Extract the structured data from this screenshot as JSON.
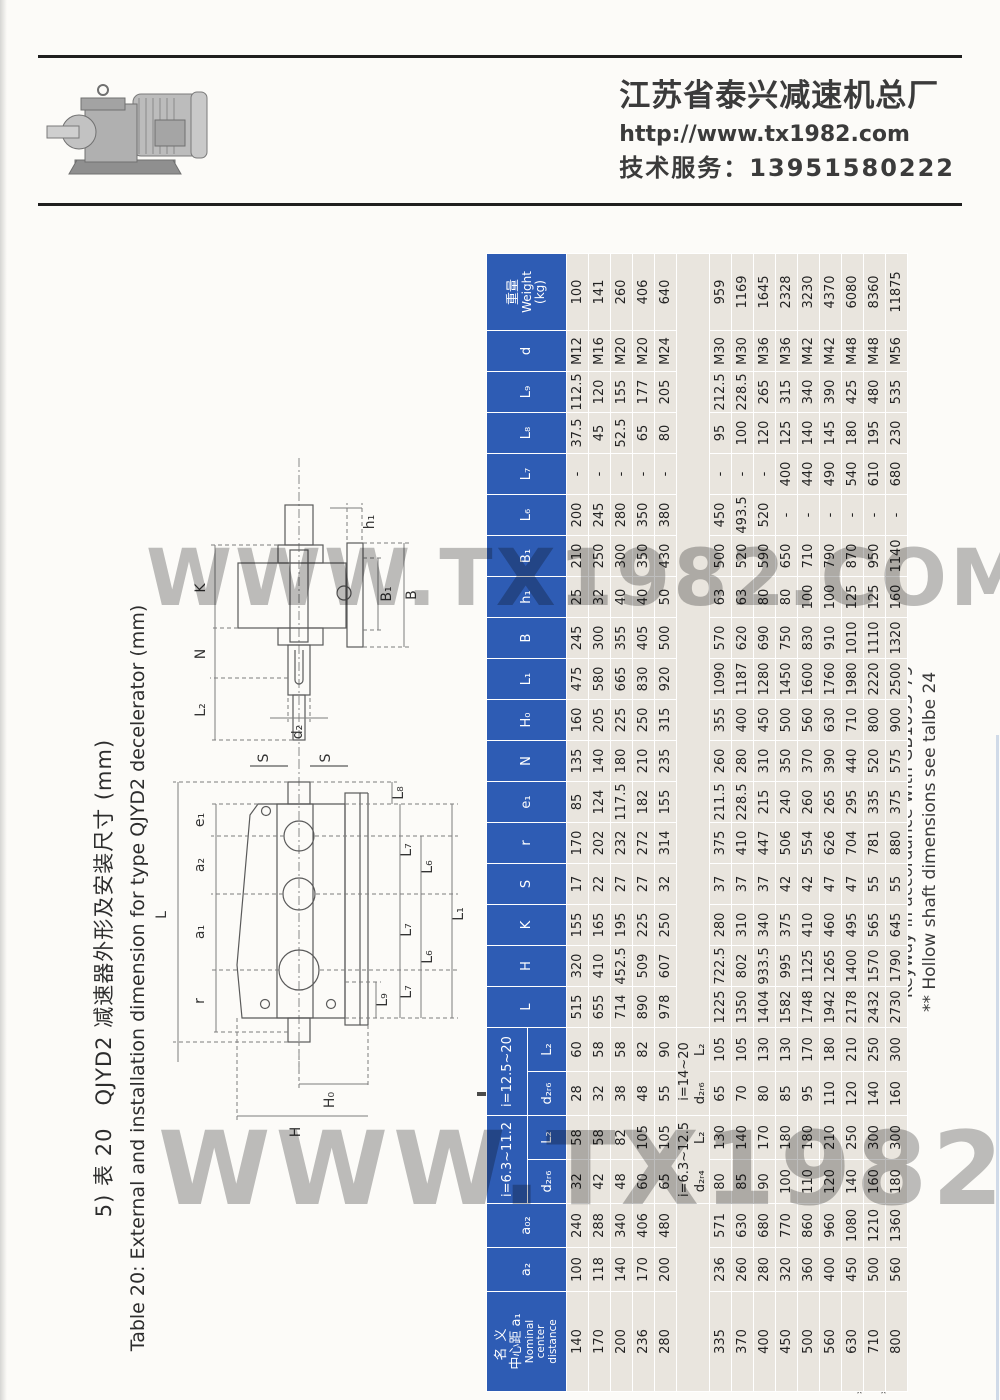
{
  "header": {
    "company": "江苏省泰兴减速机总厂",
    "website": "http://www.tx1982.com",
    "service": "技术服务：13951580222"
  },
  "watermark": "WWW.TX1982.COM",
  "title": {
    "zh": "5) 表 20　QJYD2 减速器外形及安装尺寸 (mm)",
    "en": "Table 20: External and installation dimension for type QJYD2 decelerator (mm)"
  },
  "table": {
    "headers": {
      "a1_zh1": "名义",
      "a1_zh2": "中心距 a₁",
      "a1_en1": "Nominal",
      "a1_en2": "center",
      "a1_en3": "distance",
      "a2": "a₂",
      "a02": "a₀₂",
      "group1": "i=6.3~11.2",
      "group2": "i=12.5~20",
      "g1_d": "d₂ᵣ₆",
      "g1_l2": "L₂",
      "g2_d": "d₂ᵣ₆",
      "g2_l2": "L₂",
      "cols": [
        "L",
        "H",
        "K",
        "S",
        "r",
        "e₁",
        "N",
        "H₀",
        "L₁",
        "B",
        "h₁",
        "B₁",
        "L₆",
        "L₇",
        "L₈",
        "L₉",
        "d"
      ],
      "weight_zh": "重量",
      "weight_en": "Weight",
      "weight_unit": "(kg)"
    },
    "mid": {
      "g1_range": "i=6.3~12.5",
      "g1_d": "d₂ᵣ₄",
      "g1_l2": "L₂",
      "g2_range": "i=14~20",
      "g2_d": "d₂ᵣ₆",
      "g2_l2": "L₂"
    },
    "rows_small": [
      [
        "140",
        "100",
        "240",
        "32",
        "58",
        "28",
        "60",
        "515",
        "320",
        "155",
        "17",
        "170",
        "85",
        "135",
        "160",
        "475",
        "245",
        "25",
        "210",
        "200",
        "-",
        "37.5",
        "112.5",
        "M12",
        "100"
      ],
      [
        "170",
        "118",
        "288",
        "42",
        "58",
        "32",
        "58",
        "655",
        "410",
        "165",
        "22",
        "202",
        "124",
        "140",
        "205",
        "580",
        "300",
        "32",
        "250",
        "245",
        "-",
        "45",
        "120",
        "M16",
        "141"
      ],
      [
        "200",
        "140",
        "340",
        "48",
        "82",
        "38",
        "58",
        "714",
        "452.5",
        "195",
        "27",
        "232",
        "117.5",
        "180",
        "225",
        "665",
        "355",
        "40",
        "300",
        "280",
        "-",
        "52.5",
        "155",
        "M20",
        "260"
      ],
      [
        "236",
        "170",
        "406",
        "60",
        "105",
        "48",
        "82",
        "890",
        "509",
        "225",
        "27",
        "272",
        "182",
        "210",
        "250",
        "830",
        "405",
        "40",
        "350",
        "350",
        "-",
        "65",
        "177",
        "M20",
        "406"
      ],
      [
        "280",
        "200",
        "480",
        "65",
        "105",
        "55",
        "90",
        "978",
        "607",
        "250",
        "32",
        "314",
        "155",
        "235",
        "315",
        "920",
        "500",
        "50",
        "430",
        "380",
        "-",
        "80",
        "205",
        "M24",
        "640"
      ]
    ],
    "rows_large": [
      [
        "335",
        "236",
        "571",
        "80",
        "130",
        "65",
        "105",
        "1225",
        "722.5",
        "280",
        "37",
        "375",
        "211.5",
        "260",
        "355",
        "1090",
        "570",
        "63",
        "500",
        "450",
        "-",
        "95",
        "212.5",
        "M30",
        "959"
      ],
      [
        "370",
        "260",
        "630",
        "85",
        "140",
        "70",
        "105",
        "1350",
        "802",
        "310",
        "37",
        "410",
        "228.5",
        "280",
        "400",
        "1187",
        "620",
        "63",
        "520",
        "493.5",
        "-",
        "100",
        "228.5",
        "M30",
        "1169"
      ],
      [
        "400",
        "280",
        "680",
        "90",
        "170",
        "80",
        "130",
        "1404",
        "933.5",
        "340",
        "37",
        "447",
        "215",
        "310",
        "450",
        "1280",
        "690",
        "80",
        "590",
        "520",
        "-",
        "120",
        "265",
        "M36",
        "1645"
      ],
      [
        "450",
        "320",
        "770",
        "100",
        "180",
        "85",
        "130",
        "1582",
        "995",
        "375",
        "42",
        "506",
        "240",
        "350",
        "500",
        "1450",
        "750",
        "80",
        "650",
        "-",
        "400",
        "125",
        "315",
        "M36",
        "2328"
      ],
      [
        "500",
        "360",
        "860",
        "110",
        "180",
        "95",
        "170",
        "1748",
        "1125",
        "410",
        "42",
        "554",
        "260",
        "370",
        "560",
        "1600",
        "830",
        "100",
        "710",
        "-",
        "440",
        "140",
        "340",
        "M42",
        "3230"
      ],
      [
        "560",
        "400",
        "960",
        "120",
        "210",
        "110",
        "180",
        "1942",
        "1265",
        "460",
        "47",
        "626",
        "265",
        "390",
        "630",
        "1760",
        "910",
        "100",
        "790",
        "-",
        "490",
        "145",
        "390",
        "M42",
        "4370"
      ],
      [
        "630",
        "450",
        "1080",
        "140",
        "250",
        "120",
        "210",
        "2178",
        "1400",
        "495",
        "47",
        "704",
        "295",
        "440",
        "710",
        "1980",
        "1010",
        "125",
        "870",
        "-",
        "540",
        "180",
        "425",
        "M48",
        "6080"
      ],
      [
        "710",
        "500",
        "1210",
        "160",
        "300",
        "140",
        "250",
        "2432",
        "1570",
        "565",
        "55",
        "781",
        "335",
        "520",
        "800",
        "2220",
        "1110",
        "125",
        "950",
        "-",
        "610",
        "195",
        "480",
        "M48",
        "8360"
      ],
      [
        "800",
        "560",
        "1360",
        "180",
        "300",
        "160",
        "300",
        "2730",
        "1790",
        "645",
        "55",
        "880",
        "375",
        "575",
        "900",
        "2500",
        "1320",
        "160",
        "1140",
        "-",
        "680",
        "230",
        "535",
        "M56",
        "11875"
      ]
    ]
  },
  "footnotes": {
    "zh1": "* 键槽按 GB1095-79",
    "zh2": "** 空心轴有关尺寸见表 24",
    "en1": "* Keyway in accordance with GB1095-79",
    "en2": "** Hollow shaft dimensions see talbe 24"
  },
  "diagrams": {
    "d1": {
      "K": "K",
      "N": "N",
      "L2": "L₂",
      "h1": "h₁",
      "B1": "B₁",
      "B": "B",
      "d2": "d₂"
    },
    "d2": {
      "S_left": "S",
      "S_right": "S",
      "e1": "e₁",
      "a2": "a₂",
      "a1": "a₁",
      "r": "r",
      "L": "L",
      "L8": "L₈",
      "L7a": "L₇",
      "L6a": "L₆",
      "L7b": "L₇",
      "L6b": "L₆",
      "L7c": "L₇",
      "L9": "L₉",
      "L1": "L₁",
      "H0": "H₀",
      "H": "H"
    }
  }
}
